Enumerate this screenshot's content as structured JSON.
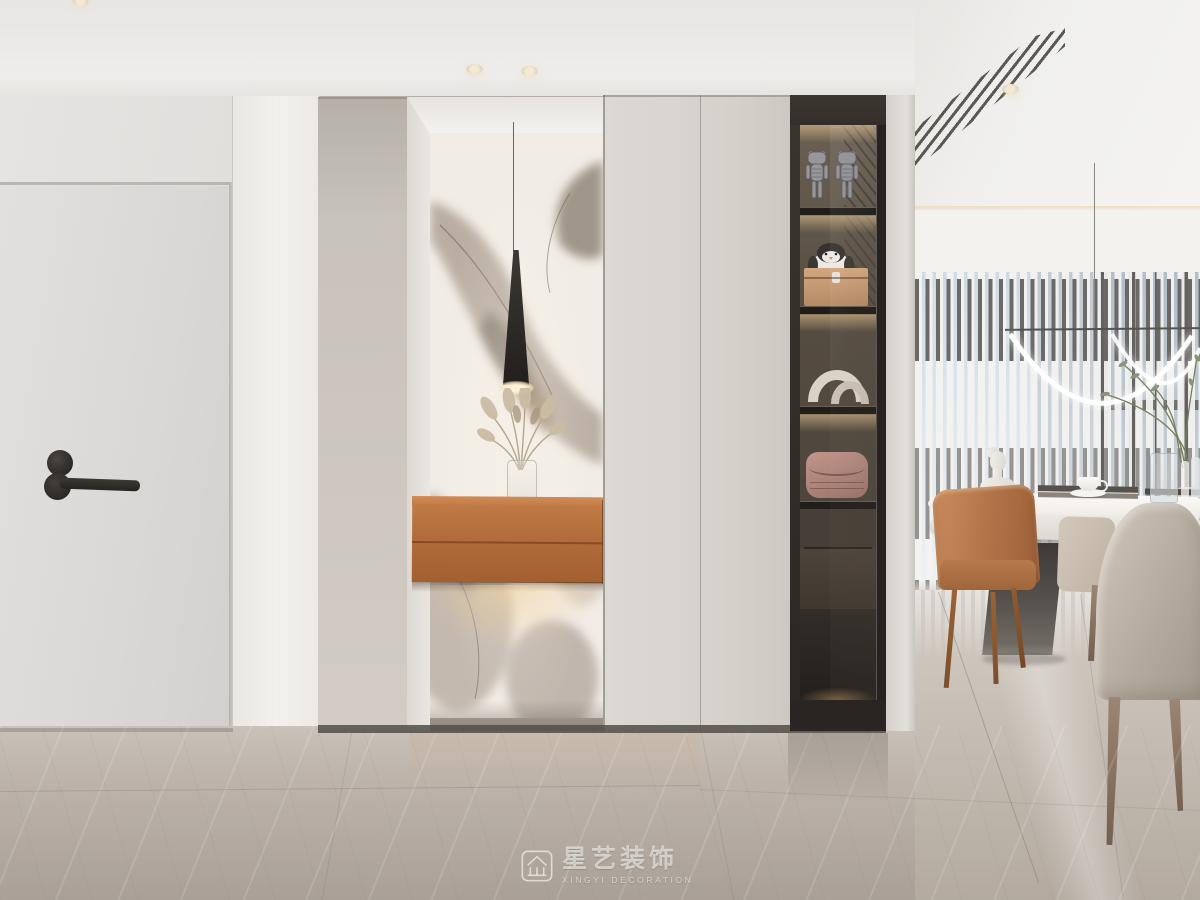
{
  "meta": {
    "domain": "Natural-Image",
    "description": "Photorealistic 3D interior render: modern entryway with marble-lined niche, orange floating console, taupe wardrobe panels, dark glass display cabinet with art toys and accessories, and a dining area with ring pendant light, marble-top table and vertical blinds over floor-to-ceiling windows"
  },
  "watermark": {
    "brand_cn": "星艺装饰",
    "brand_en": "XINGYI DECORATION",
    "logo": "pavilion-logo"
  },
  "palette": {
    "ceiling": "#eceae7",
    "wall": "#e4e2e0",
    "pillar": "#f1efec",
    "door": "#dcdad8",
    "door_hardware": "#2f2c29",
    "wardrobe_taupe": "#c2bcb5",
    "wardrobe_light": "#d7d3cd",
    "marble_wall": "#f0ebe3",
    "marble_vein": "#9c8f80",
    "console_orange": "#bd7544",
    "display_cabinet": "#332d28",
    "shelf_glow": "#e5c291",
    "floor_hallway": "#b5aca3",
    "floor_dining": "#d6d0c9",
    "sky": "#c9d9e8",
    "window_frame": "#3c3a38",
    "blinds": "#f3f2f0",
    "pendant_ring": "#ffffff",
    "table_top": "#f6f4f1",
    "table_base": "#4a4541",
    "chair_caramel": "#b97a4e",
    "chair_greige": "#b6aca0",
    "chair_beige": "#cfc5b7",
    "plant": "#7e8a6a"
  },
  "objects": [
    "entry-door",
    "door-lever-handle",
    "recessed-spotlights",
    "wardrobe-panel",
    "marble-feature-niche",
    "cone-pendant-light",
    "pampas-grass-vase",
    "floating-console-drawers",
    "wardrobe-doors",
    "display-cabinet",
    "art-toy-figures",
    "penguin-plush",
    "storage-box",
    "arch-sculpture",
    "handbag",
    "ceiling-vent",
    "ring-pendant-light",
    "vertical-blinds",
    "dining-table",
    "bust-sculpture",
    "coffee-cup",
    "books",
    "glass-vase",
    "dining-chairs",
    "marble-floor"
  ]
}
